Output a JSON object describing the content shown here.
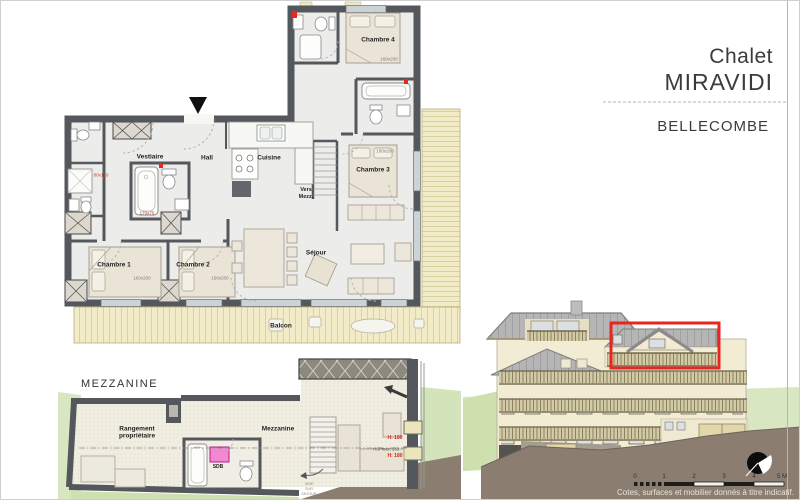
{
  "title_block": {
    "line1": "Chalet",
    "line2": "MIRAVIDI",
    "location": "BELLECOMBE"
  },
  "main_plan": {
    "rooms": {
      "vestiaire": "Vestiaire",
      "hall": "Hall",
      "cuisine": "Cuisine",
      "chambre1": "Chambre 1",
      "chambre2": "Chambre 2",
      "chambre3": "Chambre 3",
      "chambre4": "Chambre 4",
      "sejour": "Séjour",
      "balcon": "Balcon",
      "vers_mezz_line1": "Vers",
      "vers_mezz_line2": "Mezz."
    },
    "dims": {
      "chambre1": "160x200",
      "chambre2": "160x200",
      "chambre3": "160x200",
      "chambre4": "160x200",
      "bathtub": "170x75",
      "shower": "80x120"
    }
  },
  "mezzanine_plan": {
    "title": "MEZZANINE",
    "rooms": {
      "rangement_line1": "Rangement",
      "rangement_line2": "propriétaire",
      "mezzanine": "Mezzanine",
      "sdb": "SDB"
    },
    "annotations": {
      "height_upper": "H: 180",
      "hsp_max": "HSPmax: 133",
      "height_lower": "H: 180",
      "vide_line1": "VIDE",
      "vide_line2": "SUR",
      "vide_line3": "SEJOUR"
    }
  },
  "footer": {
    "scale_labels": [
      "0",
      "1",
      "2",
      "3",
      "4",
      "5 M"
    ],
    "disclaimer": "Cotes, surfaces et mobilier donnés à titre indicatif."
  },
  "colors": {
    "highlight": "#e8251f",
    "wall": "#54575b",
    "deck": "#f1ecc7",
    "grass": "#d9e6c2",
    "ground": "#8b7d6f",
    "pink_fixture": "#f486d2",
    "roof": "#b5b5b5",
    "facade": "#f2ecd4"
  }
}
